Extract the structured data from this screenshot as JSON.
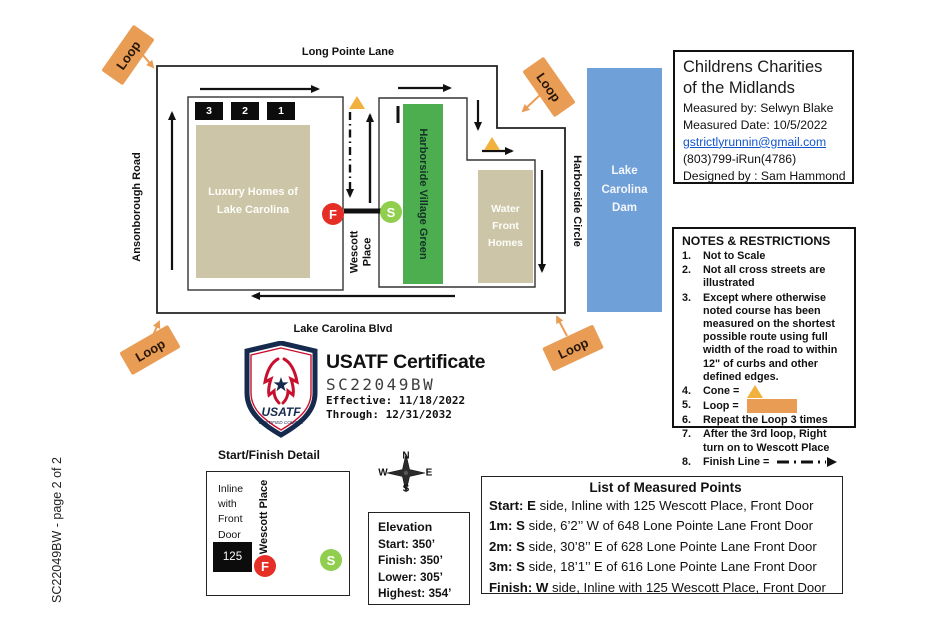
{
  "page_label": "SC22049BW - page 2 of 2",
  "colors": {
    "banner_orange": "#E99C54",
    "cone_gold": "#F2B13D",
    "village_green": "#4CAE4F",
    "start_green": "#90CE4E",
    "finish_red": "#E52E25",
    "homes_tan": "#CCC5A7",
    "dam_blue": "#6FA0D8",
    "link_blue": "#1155CC",
    "usatf_navy": "#162A4E",
    "usatf_red": "#C8102E"
  },
  "map": {
    "loop_label": "Loop",
    "streets": {
      "top": "Long Pointe Lane",
      "left": "Ansonborough Road",
      "bottom": "Lake Carolina Blvd",
      "right": "Harborside Circle",
      "center": "Wescott Place"
    },
    "blocks": {
      "luxury_homes": "Luxury Homes of Lake Carolina",
      "village_green": "Harborside Village Green",
      "water_front_homes": "Water Front Homes",
      "dam": "Lake Carolina Dam"
    },
    "loop_markers": [
      "3",
      "2",
      "1"
    ],
    "start_label": "S",
    "finish_label": "F"
  },
  "title_box": {
    "title_line1": "Childrens  Charities",
    "title_line2": "of the Midlands",
    "measured_by": "Measured by: Selwyn Blake",
    "measured_date": "Measured Date:  10/5/2022",
    "email": "gstrictlyrunnin@gmail.com",
    "phone": "(803)799-iRun(4786)",
    "designed_by": "Designed by : Sam Hammond"
  },
  "notes": {
    "title": "NOTES & RESTRICTIONS",
    "items": [
      {
        "num": "1.",
        "text": "Not to Scale"
      },
      {
        "num": "2.",
        "text": "Not all cross streets are illustrated"
      },
      {
        "num": "3.",
        "text": "Except where otherwise noted course has been measured on the shortest possible route using full width of the road to within 12\" of curbs and other defined edges."
      },
      {
        "num": "4.",
        "text": "Cone ="
      },
      {
        "num": "5.",
        "text": "Loop ="
      },
      {
        "num": "6.",
        "text": "Repeat the Loop 3 times"
      },
      {
        "num": "7.",
        "text": "After the 3rd loop, Right turn on to Wescott Place"
      },
      {
        "num": "8.",
        "text": "Finish Line ="
      }
    ]
  },
  "certificate": {
    "heading": "USATF Certificate",
    "number": "SC22049BW",
    "effective": "Effective: 11/18/2022",
    "through": "Through:  12/31/2032",
    "shield_name": "USATF",
    "shield_sub": "CERTIFIED COURSE"
  },
  "detail": {
    "title": "Start/Finish Detail",
    "note": "Inline with Front Door",
    "house_number": "125",
    "street": "Wescott Place",
    "start_label": "S",
    "finish_label": "F"
  },
  "compass": {
    "n": "N",
    "s": "S",
    "e": "E",
    "w": "W"
  },
  "elevation": {
    "title": "Elevation",
    "lines": [
      "Start:  350’",
      "Finish: 350’",
      "Lower: 305’",
      "Highest:  354’"
    ]
  },
  "measured_points": {
    "title": "List of Measured Points",
    "rows": [
      {
        "bold": "Start: E",
        "rest": " side,  Inline with 125 Wescott Place, Front Door"
      },
      {
        "bold": "1m: S",
        "rest": " side,  6’2’’ W of 648 Lone Pointe Lane Front Door"
      },
      {
        "bold": "2m: S",
        "rest": " side, 30’8’’ E of 628  Lone Pointe Lane Front Door"
      },
      {
        "bold": "3m: S",
        "rest": " side,  18’1’’ E of 616  Lone Pointe Lane Front Door"
      },
      {
        "bold": "Finish: W",
        "rest": " side, Inline with 125 Wescott Place, Front Door"
      }
    ]
  }
}
